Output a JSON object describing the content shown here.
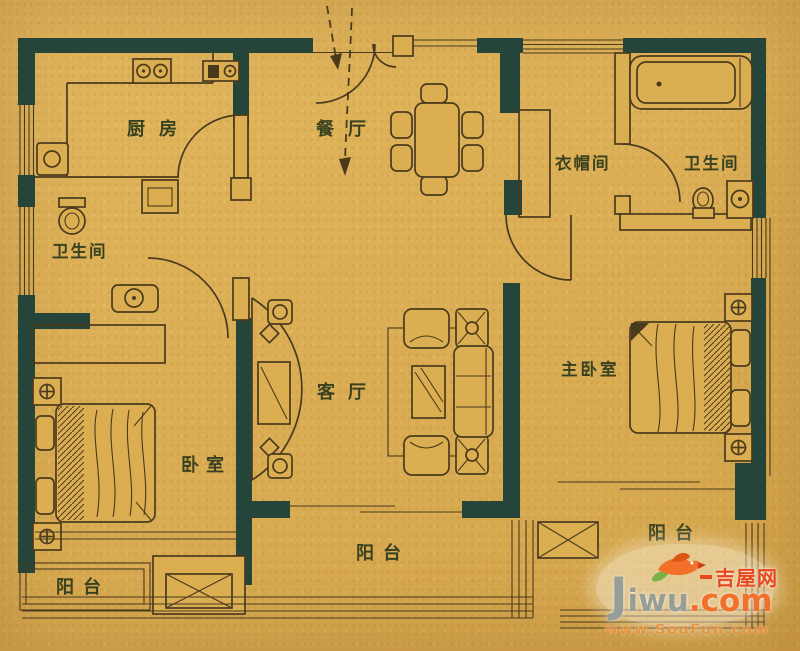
{
  "plan": {
    "type": "apartment-floor-plan",
    "colors": {
      "background": "#dcae52",
      "wall": "#25443a",
      "line": "#4a3a1d",
      "label": "#39411f",
      "watermark_orange": "#f2702a",
      "watermark_red_orange": "#e8481d",
      "watermark_gray": "#969e98",
      "watermark_green": "#79b345",
      "soufun_orange": "#e68c32"
    },
    "rooms": {
      "kitchen": {
        "label": "厨房"
      },
      "dining": {
        "label": "餐厅"
      },
      "cloakroom": {
        "label": "衣帽间"
      },
      "bath_right": {
        "label": "卫生间"
      },
      "bath_left": {
        "label": "卫生间"
      },
      "living": {
        "label": "客厅"
      },
      "master_bedroom": {
        "label": "主卧室"
      },
      "bedroom": {
        "label": "卧室"
      },
      "balcony_left": {
        "label": "阳台"
      },
      "balcony_center": {
        "label": "阳台"
      },
      "balcony_right": {
        "label": "阳台"
      }
    },
    "icons": {
      "stove-icon": "two-burner cooktop",
      "sink-icon": "kitchen sink square",
      "toilet-icon": "toilet",
      "washbasin-icon": "basin with faucet",
      "bathtub-icon": "bathtub",
      "bed-icon": "bed with wavy blanket",
      "nightstand-icon": "square with flower",
      "dining-table-icon": "table with six chairs",
      "sofa-icon": "sofa set with coffee table",
      "tv-cabinet-icon": "curved TV cabinet",
      "wardrobe-icon": "hatched closet strip",
      "ac-platform-icon": "crossed box",
      "entry-arrow-icon": "dashed entry arrows",
      "door-icon": "quarter-circle swing arc",
      "window-icon": "parallel line glazing"
    },
    "watermark": {
      "site_initial": "J",
      "site_rest": "iwu",
      "site_tld": ".com",
      "site_cn": "吉屋网",
      "source_url": "www.SouFun.com"
    }
  }
}
